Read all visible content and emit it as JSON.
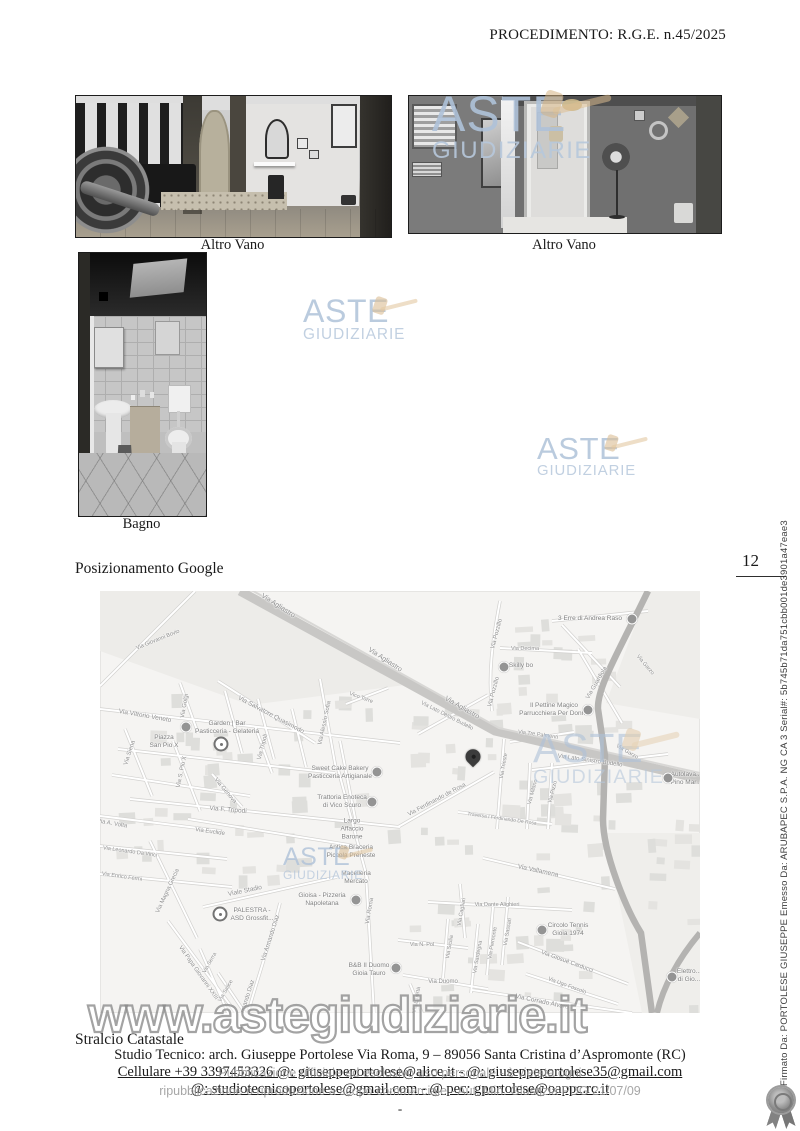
{
  "header": {
    "procedimento": "PROCEDIMENTO: R.G.E. n.45/2025"
  },
  "photos": [
    {
      "caption": "Altro Vano"
    },
    {
      "caption": "Altro Vano"
    },
    {
      "caption": "Bagno"
    }
  ],
  "sections": {
    "posizionamento_heading": "Posizionamento Google",
    "stralcio_heading": "Stralcio Catastale"
  },
  "watermark": {
    "line1": "ASTE",
    "line2": "GIUDIZIARIE",
    "url_text": "www.astegiudiziarie.it"
  },
  "margin": {
    "page_number": "12",
    "signature_text": "Firmato Da: PORTOLESE GIUSEPPE Emesso Da: ARUBAPEC S.P.A. NG CA 3 Serial#: 5b745b71da751cbb001de3901a47eae3"
  },
  "footer": {
    "studio_line": "Studio Tecnico: arch. Giuseppe Portolese Via Roma, 9 – 89056 Santa Cristina d’Aspromonte (RC)",
    "contacts_line1": "Cellulare +39 3397453326 @: giuseppeportolese@alice.it - @: giuseppeportolese35@gmail.com",
    "contacts_line2": "@: studiotecnicoportolese@gmail.com - @ pec: gportolese@oappc.rc.it",
    "legal_line1": "Pubblicazione ufficiale ad esclusivo uso personale - è vietata ogni",
    "legal_line2": "ripubblicazione o riproduzione a scopo commerciale - Aut. Min. Giustizia PDG 21/07/09",
    "page_dash": "-"
  },
  "colors": {
    "watermark_blue": "#afc2d9",
    "gavel_beige": "#debe91",
    "map_background": "#f5f4f2",
    "map_label_gray": "#8f8f8f"
  },
  "map": {
    "pin": {
      "x": 373,
      "y": 172
    },
    "markers": [
      {
        "x": 121,
        "y": 153
      },
      {
        "x": 120,
        "y": 323
      }
    ],
    "streets": [
      {
        "t": "Via Agliastro",
        "x": 178,
        "y": 15,
        "r": 33,
        "s": 7
      },
      {
        "t": "Via Agliastro",
        "x": 285,
        "y": 69,
        "r": 33,
        "s": 7
      },
      {
        "t": "Via Agliastro",
        "x": 362,
        "y": 117,
        "r": 30,
        "s": 7
      },
      {
        "t": "Via Giovanni Bovio",
        "x": 58,
        "y": 49,
        "r": -22,
        "s": 5.5
      },
      {
        "t": "Via Vittorio Veneto",
        "x": 45,
        "y": 125,
        "r": 10,
        "s": 6.5
      },
      {
        "t": "Via Siena",
        "x": 30,
        "y": 162,
        "r": -72,
        "s": 6
      },
      {
        "t": "Via Golgi",
        "x": 85,
        "y": 115,
        "r": -80,
        "s": 6
      },
      {
        "t": "Via S. Pio X",
        "x": 82,
        "y": 181,
        "r": -78,
        "s": 6
      },
      {
        "t": "Via Salvatore Quasimodo",
        "x": 171,
        "y": 124,
        "r": 28,
        "s": 6.5
      },
      {
        "t": "Via Tripoli",
        "x": 163,
        "y": 156,
        "r": -75,
        "s": 6
      },
      {
        "t": "Via Alessio Sofia",
        "x": 225,
        "y": 132,
        "r": -78,
        "s": 6
      },
      {
        "t": "Vico Torre",
        "x": 261,
        "y": 107,
        "r": 20,
        "s": 5.5
      },
      {
        "t": "Via Genova",
        "x": 125,
        "y": 200,
        "r": 50,
        "s": 6
      },
      {
        "t": "Via F. Tripodi",
        "x": 128,
        "y": 219,
        "r": 5,
        "s": 6.5
      },
      {
        "t": "Via Euclide",
        "x": 110,
        "y": 241,
        "r": 8,
        "s": 6
      },
      {
        "t": "Via A. Volta",
        "x": 12,
        "y": 233,
        "r": 10,
        "s": 6
      },
      {
        "t": "Via Leonardo Da Vinci",
        "x": 30,
        "y": 261,
        "r": 8,
        "s": 5.5
      },
      {
        "t": "Via Enrico Fermi",
        "x": 22,
        "y": 286,
        "r": 8,
        "s": 5.5
      },
      {
        "t": "Via Magna Grecia",
        "x": 68,
        "y": 300,
        "r": -65,
        "s": 6
      },
      {
        "t": "Viale Stadio",
        "x": 145,
        "y": 300,
        "r": -12,
        "s": 6.5
      },
      {
        "t": "Via Papa Giovanni XXIII",
        "x": 98,
        "y": 382,
        "r": 55,
        "s": 6
      },
      {
        "t": "Via Serra",
        "x": 110,
        "y": 372,
        "r": -60,
        "s": 5.5
      },
      {
        "t": "Via Salice",
        "x": 126,
        "y": 400,
        "r": -60,
        "s": 5.5
      },
      {
        "t": "Via Armando Diaz",
        "x": 171,
        "y": 347,
        "r": -72,
        "s": 6
      },
      {
        "t": "Via Armando Diaz",
        "x": 146,
        "y": 412,
        "r": -72,
        "s": 6
      },
      {
        "t": "Via Pozzillo",
        "x": 397,
        "y": 43,
        "r": -75,
        "s": 6
      },
      {
        "t": "Via Pozzillo",
        "x": 394,
        "y": 101,
        "r": -75,
        "s": 6
      },
      {
        "t": "Via Decima",
        "x": 425,
        "y": 58,
        "r": 0,
        "s": 5.5
      },
      {
        "t": "Via Guardiola",
        "x": 497,
        "y": 92,
        "r": -60,
        "s": 6
      },
      {
        "t": "Via Garzo",
        "x": 545,
        "y": 74,
        "r": 50,
        "s": 5.5
      },
      {
        "t": "Via Garzo",
        "x": 527,
        "y": 161,
        "r": 30,
        "s": 5.5
      },
      {
        "t": "Via Lato Destro Budello",
        "x": 347,
        "y": 125,
        "r": 27,
        "s": 5.5
      },
      {
        "t": "Via Tre Palmenti",
        "x": 438,
        "y": 144,
        "r": 8,
        "s": 5.5
      },
      {
        "t": "Via Lato Sinistro Budello",
        "x": 490,
        "y": 170,
        "r": 8,
        "s": 6
      },
      {
        "t": "Via Ferdinando de Rosa",
        "x": 337,
        "y": 209,
        "r": -28,
        "s": 6
      },
      {
        "t": "Traversa I Ferdinando De Rosa",
        "x": 402,
        "y": 228,
        "r": 8,
        "s": 5
      },
      {
        "t": "Via Trieste",
        "x": 404,
        "y": 175,
        "r": -80,
        "s": 5.5
      },
      {
        "t": "Via Milano",
        "x": 433,
        "y": 201,
        "r": -75,
        "s": 5.5
      },
      {
        "t": "Via Pizzo",
        "x": 453,
        "y": 201,
        "r": -75,
        "s": 5.5
      },
      {
        "t": "Via Vallamena",
        "x": 438,
        "y": 280,
        "r": 12,
        "s": 6.5
      },
      {
        "t": "Via Dante Alighieri",
        "x": 397,
        "y": 314,
        "r": 0,
        "s": 5.5
      },
      {
        "t": "Via Cagliari",
        "x": 362,
        "y": 321,
        "r": -80,
        "s": 5.5
      },
      {
        "t": "Via N. Pol",
        "x": 322,
        "y": 354,
        "r": 0,
        "s": 5.5
      },
      {
        "t": "Via Sicilia",
        "x": 350,
        "y": 356,
        "r": -80,
        "s": 5.5
      },
      {
        "t": "Via Sardegna",
        "x": 378,
        "y": 366,
        "r": -80,
        "s": 5.5
      },
      {
        "t": "Via Piemonte",
        "x": 393,
        "y": 352,
        "r": -80,
        "s": 5.5
      },
      {
        "t": "Via Sassari",
        "x": 408,
        "y": 341,
        "r": -80,
        "s": 5.5
      },
      {
        "t": "Via Giosuè Carducci",
        "x": 467,
        "y": 371,
        "r": 20,
        "s": 6
      },
      {
        "t": "Via Ugo Foscolo",
        "x": 467,
        "y": 395,
        "r": 20,
        "s": 5.5
      },
      {
        "t": "Via Corrado Alvaro",
        "x": 442,
        "y": 411,
        "r": 12,
        "s": 6.5
      },
      {
        "t": "Via Duomo",
        "x": 343,
        "y": 391,
        "r": 0,
        "s": 6
      },
      {
        "t": "Via Libertà",
        "x": 317,
        "y": 409,
        "r": -80,
        "s": 5.5
      },
      {
        "t": "Via Roma",
        "x": 270,
        "y": 320,
        "r": -80,
        "s": 6
      }
    ],
    "pois": [
      {
        "lines": [
          "Garden | Bar",
          "Pasticceria - Gelateria"
        ],
        "x": 127,
        "y": 137,
        "ix": 86,
        "iy": 136
      },
      {
        "lines": [
          "Piazza",
          "San Pio X"
        ],
        "x": 64,
        "y": 151
      },
      {
        "lines": [
          "Sweet Cake Bakery",
          "Pasticceria Artigianale"
        ],
        "x": 240,
        "y": 182,
        "ix": 277,
        "iy": 181
      },
      {
        "lines": [
          "Trattoria Enoteca",
          "di Vico Scuro"
        ],
        "x": 242,
        "y": 211,
        "ix": 272,
        "iy": 211
      },
      {
        "lines": [
          "Skilly bo"
        ],
        "x": 421,
        "y": 75,
        "ix": 404,
        "iy": 76
      },
      {
        "lines": [
          "3 Erre di Andrea Raso"
        ],
        "x": 490,
        "y": 28,
        "ix": 532,
        "iy": 28
      },
      {
        "lines": [
          "Il Pettine Magico",
          "Parrucchiera Per Donna"
        ],
        "x": 454,
        "y": 119,
        "ix": 488,
        "iy": 119
      },
      {
        "lines": [
          "Autolava...",
          "Pino Mar..."
        ],
        "x": 586,
        "y": 188,
        "ix": 568,
        "iy": 187
      },
      {
        "lines": [
          "Largo",
          "Affaccio",
          "Barone"
        ],
        "x": 252,
        "y": 238
      },
      {
        "lines": [
          "Antica Braceria",
          "Piccola Preneste"
        ],
        "x": 251,
        "y": 261
      },
      {
        "lines": [
          "Macelleria",
          "Mercato"
        ],
        "x": 256,
        "y": 287
      },
      {
        "lines": [
          "Gioisa - Pizzeria",
          "Napoletana"
        ],
        "x": 222,
        "y": 309,
        "ix": 256,
        "iy": 309
      },
      {
        "lines": [
          "PALESTRA -",
          "ASD Grossfit..."
        ],
        "x": 152,
        "y": 324
      },
      {
        "lines": [
          "B&B Il Duomo",
          "Gioia Tauro"
        ],
        "x": 269,
        "y": 379,
        "ix": 296,
        "iy": 377
      },
      {
        "lines": [
          "Circolo Tennis",
          "Gioia 1974"
        ],
        "x": 468,
        "y": 339,
        "ix": 442,
        "iy": 339
      },
      {
        "lines": [
          "Elettro...",
          "di Gio..."
        ],
        "x": 589,
        "y": 385,
        "ix": 572,
        "iy": 386
      }
    ]
  }
}
